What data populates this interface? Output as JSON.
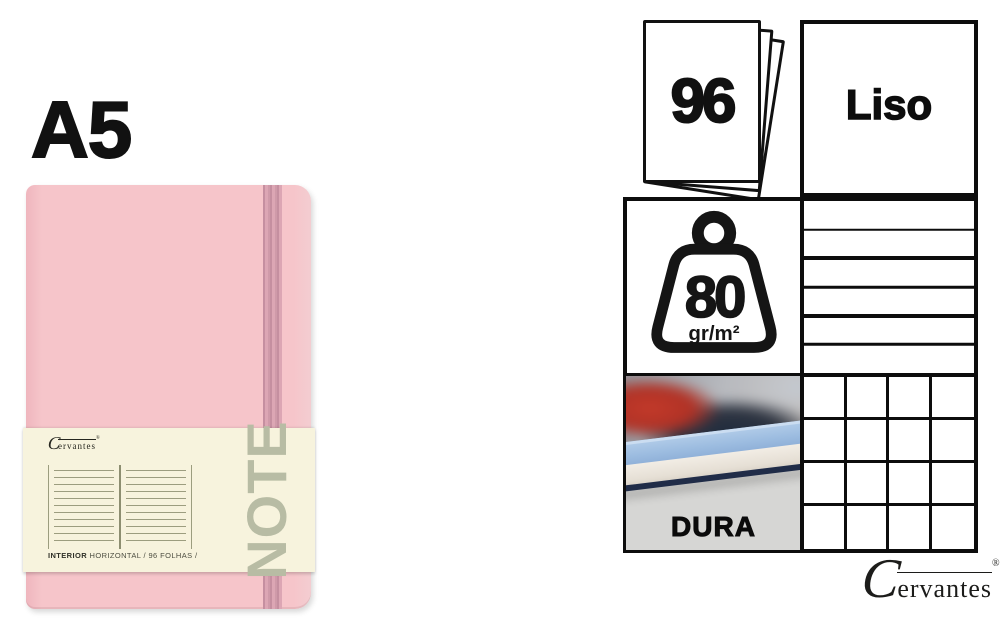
{
  "left": {
    "size_label": "A5",
    "band": {
      "interior_bold": "INTERIOR",
      "interior_rest": "HORIZONTAL / 96 FOLHAS /",
      "note_text": "NOTE"
    }
  },
  "specs": {
    "sheets_value": "96",
    "paper_type": "Liso",
    "weight_value": "80",
    "weight_unit": "gr/m²",
    "cover_label": "DURA",
    "patterns": {
      "lined_rows": 6,
      "grid_rows": 4,
      "grid_cols": 4
    }
  },
  "brand": {
    "logo_c": "C",
    "logo_rest": "ervantes",
    "reg": "®"
  },
  "colors": {
    "cover_pink": "#f6c5ca",
    "elastic_pink": "#d8a5b2",
    "band_cream": "#f7f3dd",
    "note_gray_green": "#b8bca4",
    "ruling_olive": "#9c9d7f",
    "ink_black": "#0d0d0d",
    "hardcover_blue": "#9cbce0"
  }
}
